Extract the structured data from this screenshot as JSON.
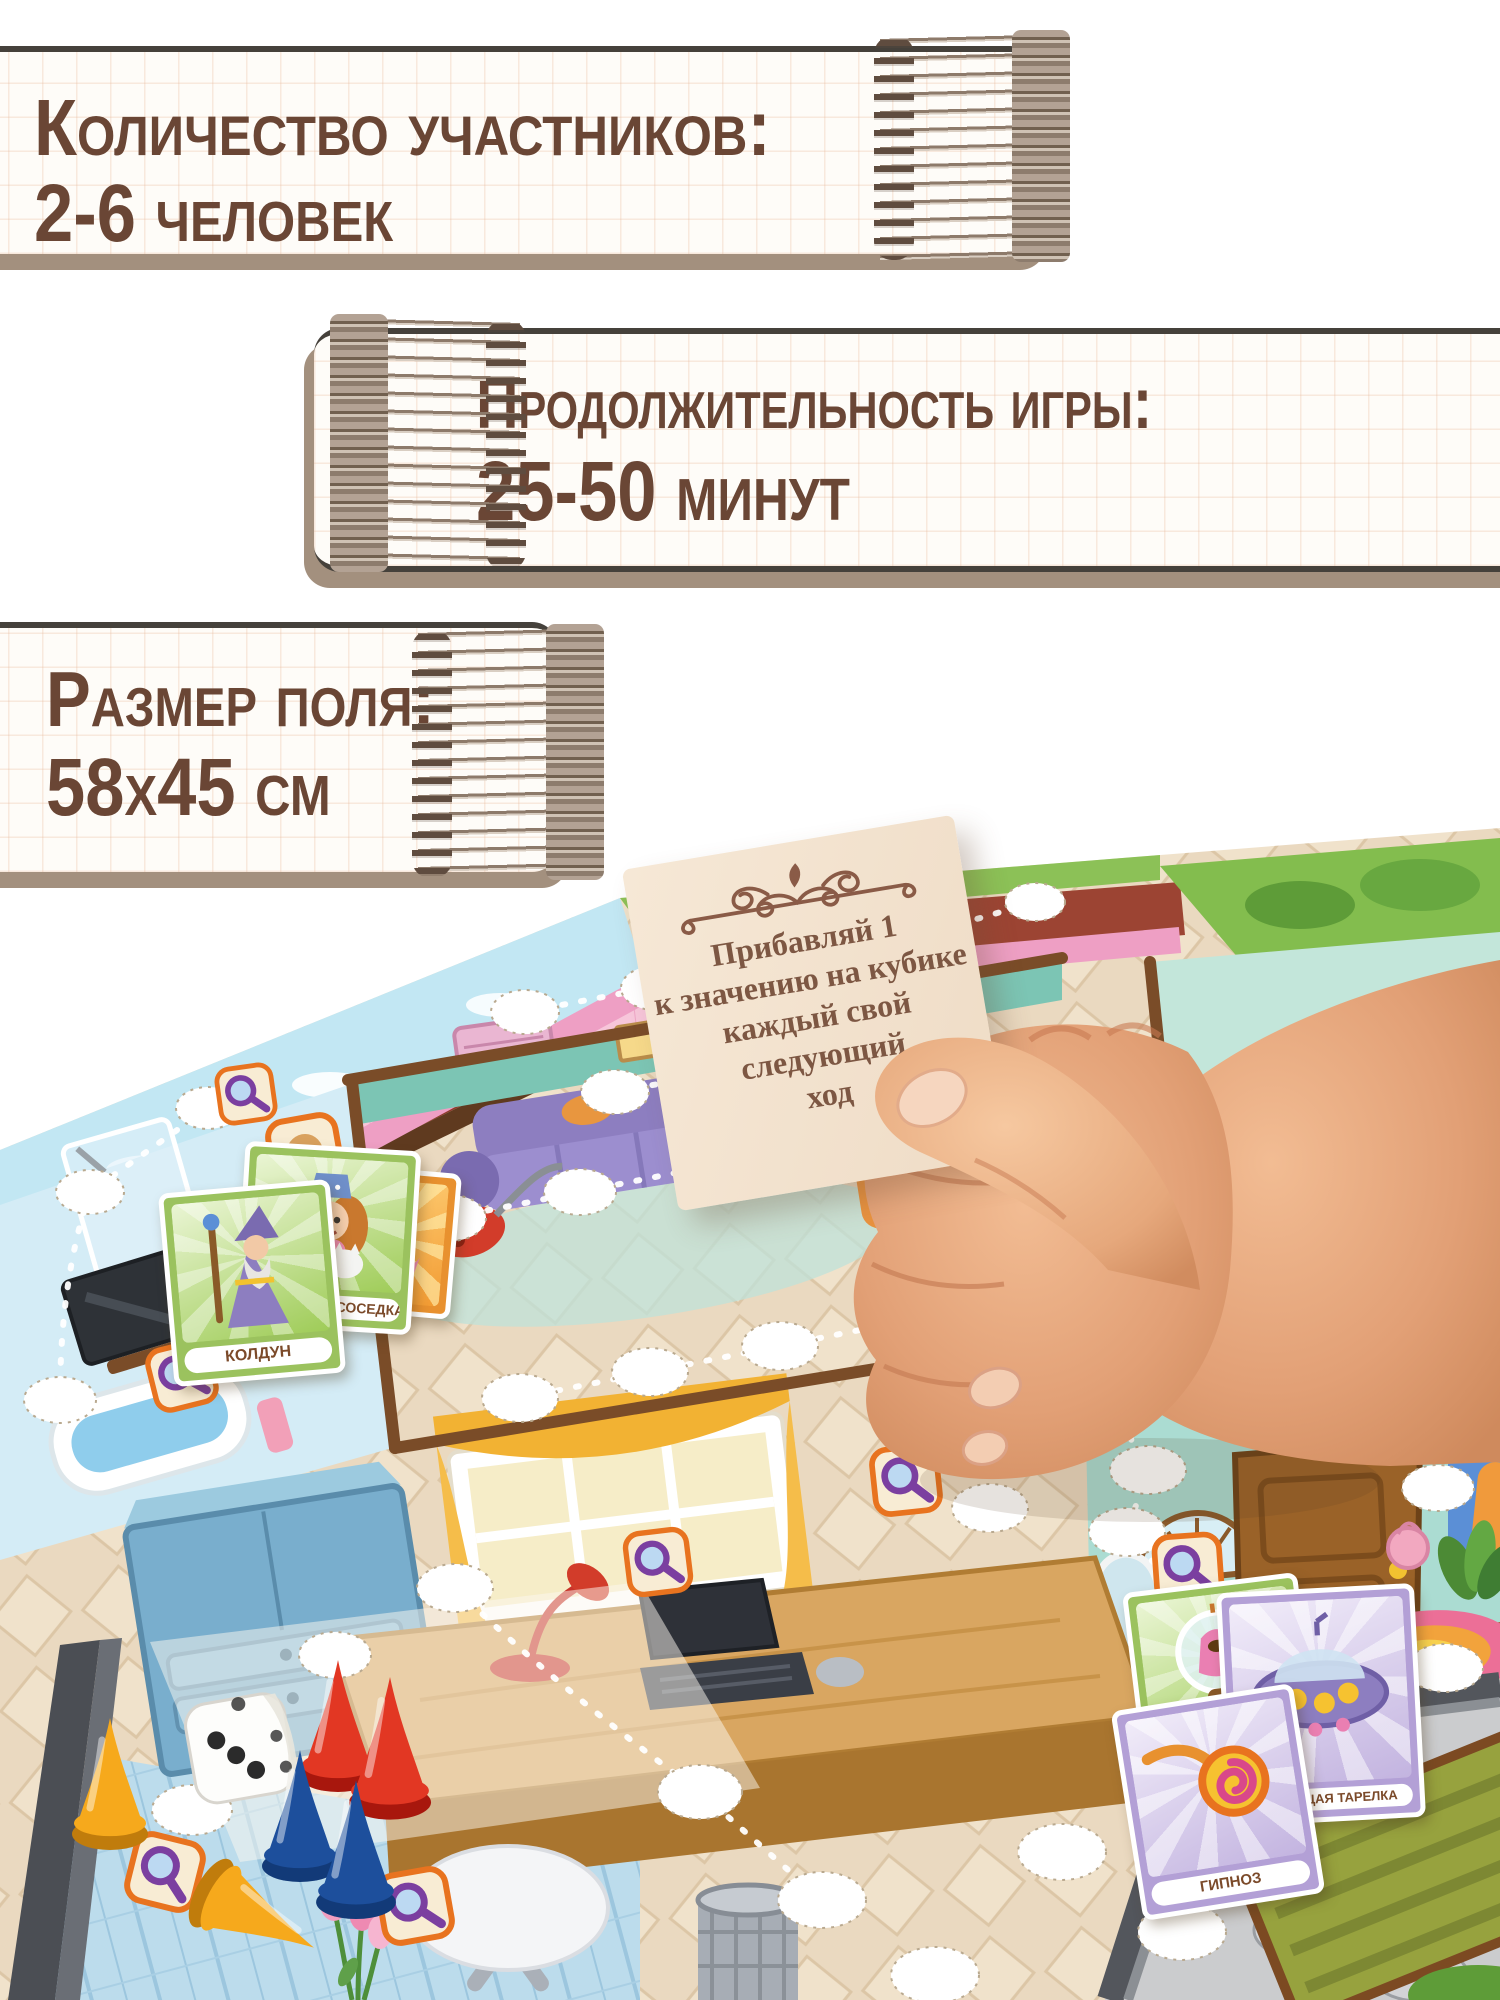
{
  "info_banners": [
    {
      "title": "Количество участников:",
      "value": "2-6 человек"
    },
    {
      "title": "Продолжительность игры:",
      "value": "25-50 минут"
    },
    {
      "title": "Размер поля:",
      "value": "58х45 см"
    }
  ],
  "held_card": {
    "lines": [
      "Прибавляй 1",
      "к значению на кубике",
      "каждый свой",
      "следующий",
      "ход"
    ]
  },
  "board": {
    "cards": {
      "wizard_label": "КОЛДУН",
      "neighbor_label": "ЧОКНУТАЯ СОСЕДКА",
      "hypnosis_label": "ГИПНОЗ",
      "saucer_label": "ЛЕТАЮЩАЯ ТАРЕЛКА"
    },
    "pieces": {
      "die_count": 1,
      "cone_colors": [
        "yellow",
        "yellow",
        "red",
        "red",
        "blue",
        "blue"
      ]
    },
    "tile_icon": "magnifier-icon"
  },
  "colors": {
    "text_brown": "#6a4635",
    "banner_shadow": "#a3907e",
    "held_card_paper": "#f3e2cf",
    "green_card_frame": "#9bc25e",
    "purple_card_frame": "#b3a0d6"
  }
}
